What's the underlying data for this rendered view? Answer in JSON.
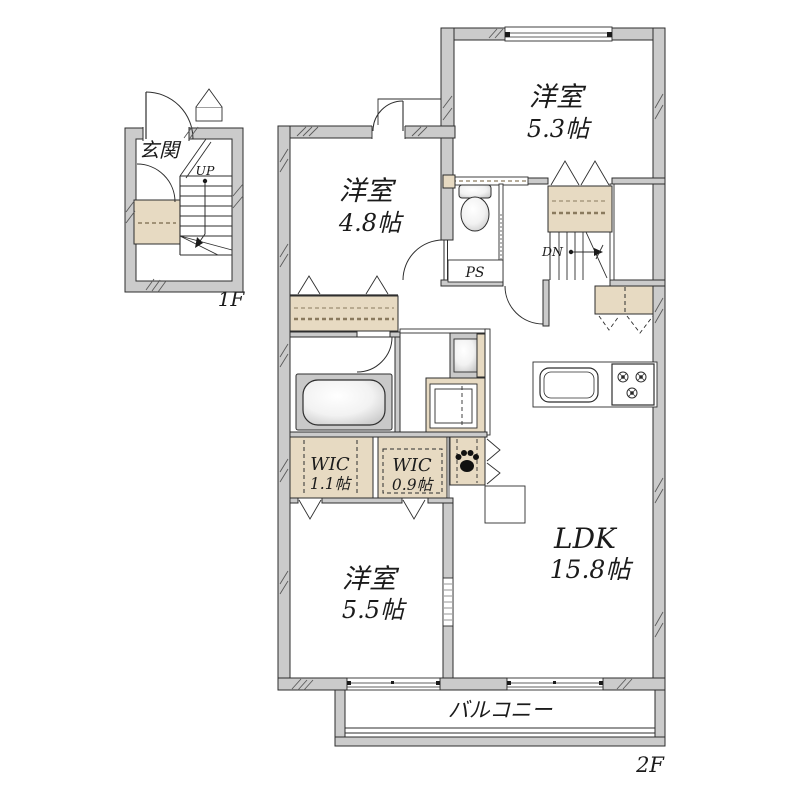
{
  "floor1": {
    "floor_label": "1F",
    "entrance": "玄関",
    "stairs_direction": "UP"
  },
  "floor2": {
    "floor_label": "2F",
    "balcony": "バルコニー",
    "pipe_space": "PS",
    "stairs_direction": "DN",
    "bedroom_ne": {
      "name": "洋室",
      "size": "5.3帖"
    },
    "bedroom_nw": {
      "name": "洋室",
      "size": "4.8帖"
    },
    "bedroom_sw": {
      "name": "洋室",
      "size": "5.5帖"
    },
    "ldk": {
      "name": "LDK",
      "size": "15.8帖"
    },
    "wic_large": {
      "name": "WIC",
      "size": "1.1帖"
    },
    "wic_small": {
      "name": "WIC",
      "size": "0.9帖"
    }
  },
  "legend": {
    "colors": {
      "wall_fill": "#cbcbcb",
      "storage_fill": "#e7dac2",
      "line": "#2e2e2e",
      "background": "#ffffff"
    },
    "icons": {
      "pet_space": "paw-icon"
    }
  }
}
